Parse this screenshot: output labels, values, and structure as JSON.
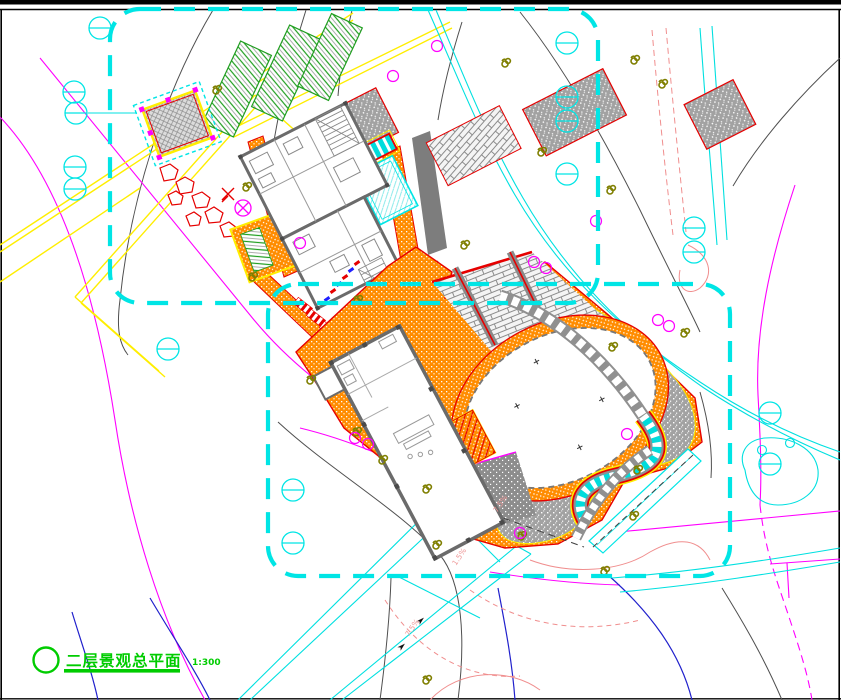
{
  "title_block": {
    "symbol": "circle-marker",
    "plan_title": "二层景观总平面",
    "scale": "1:300"
  },
  "annotations": {
    "slope_labels": [
      "7.5%",
      "7.5%",
      "1.5%"
    ]
  },
  "palette": {
    "boundary_cyan": "#00e5e5",
    "road_yellow": "#ffee00",
    "paving_orange": "#ff8c00",
    "edge_red": "#e60000",
    "bed_green": "#1f9e1f",
    "title_green": "#00cc00",
    "contour_gray": "#4f4f4f",
    "contour_magenta": "#ff00ff",
    "contour_pink": "#f08e8e",
    "contour_blue": "#2020cc",
    "tree_olive": "#7f7f00",
    "water_cyan": "#00dcdc",
    "wall_gray": "#6b6b6b"
  }
}
